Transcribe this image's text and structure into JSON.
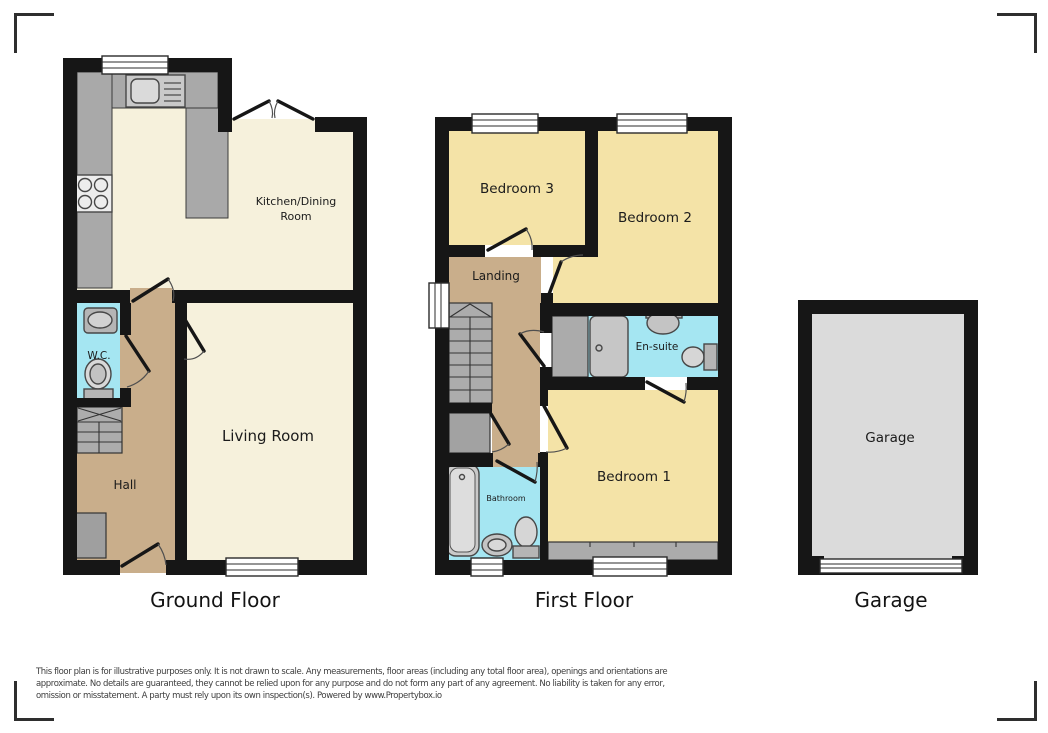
{
  "colors": {
    "wall": "#161616",
    "ground_floor_rooms": "#F6F1DC",
    "bedrooms": "#F4E3A7",
    "hall_landing": "#C9AE8B",
    "wet_rooms": "#A5E6F2",
    "counters_stairs": "#A9A9A9",
    "garage_floor": "#DBDBDB"
  },
  "floors": {
    "ground": {
      "title": "Ground Floor",
      "rooms": {
        "kitchen_dining_line1": "Kitchen/Dining",
        "kitchen_dining_line2": "Room",
        "living": "Living Room",
        "hall": "Hall",
        "wc": "W.C."
      }
    },
    "first": {
      "title": "First Floor",
      "rooms": {
        "bedroom1": "Bedroom 1",
        "bedroom2": "Bedroom 2",
        "bedroom3": "Bedroom 3",
        "landing": "Landing",
        "ensuite": "En-suite",
        "bathroom": "Bathroom"
      }
    },
    "garage": {
      "title": "Garage",
      "room": "Garage"
    }
  },
  "disclaimer": {
    "line1": "This floor plan is for illustrative purposes only. It is not drawn to scale. Any measurements, floor areas (including any total floor area), openings and orientations are",
    "line2": "approximate. No details are guaranteed, they cannot be relied upon for any purpose and do not form any part of any agreement. No liability is taken for any error,",
    "line3": "omission or misstatement. A party must rely upon its own inspection(s). Powered by www.Propertybox.io"
  }
}
